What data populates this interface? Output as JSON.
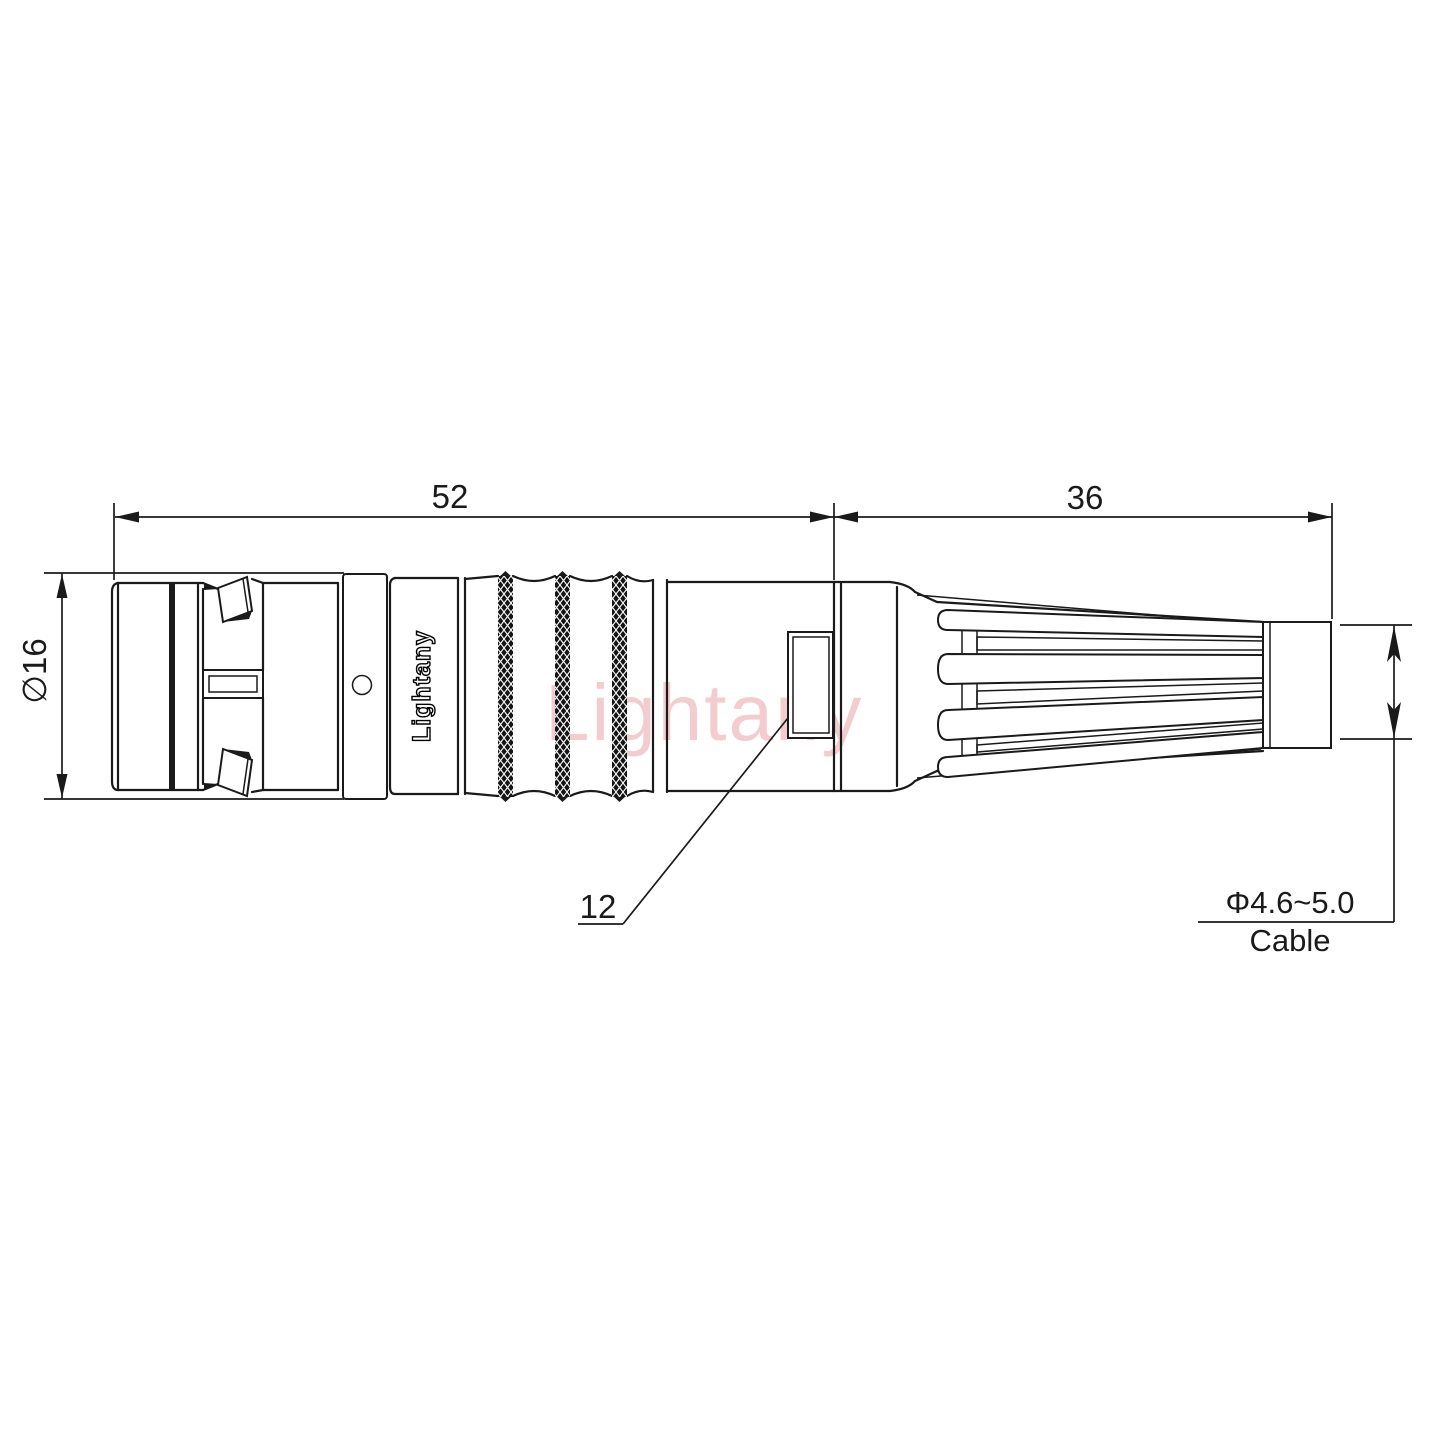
{
  "drawing": {
    "labels": {
      "front_length": "52",
      "rear_length": "36",
      "diameter": "∅16",
      "mid_feature": "12",
      "cable_diameter": "Φ4.6~5.0",
      "cable_word": "Cable"
    },
    "brand": "Lightany",
    "watermark": "Lightany",
    "colors": {
      "line": "#1a1a1a",
      "watermark_pink": "#e89aa2",
      "background": "#ffffff"
    }
  }
}
